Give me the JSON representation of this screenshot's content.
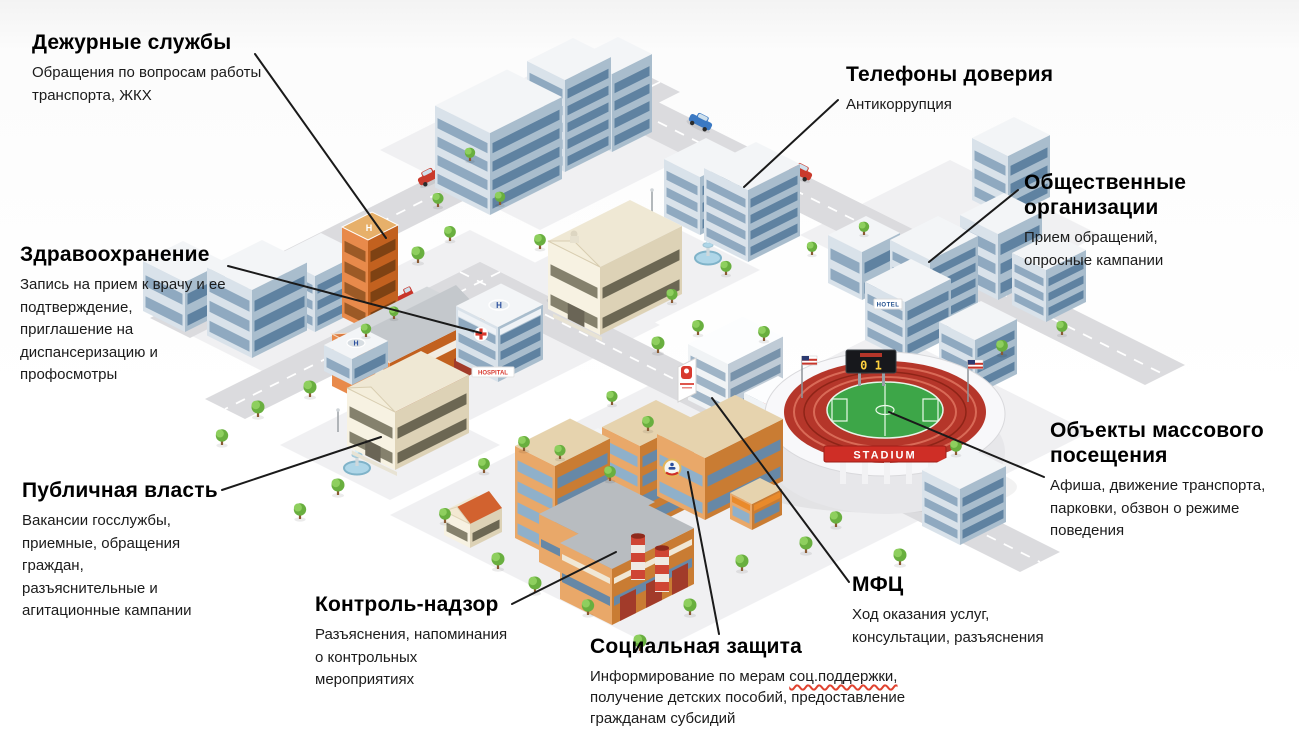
{
  "callouts": [
    {
      "id": "duty-services",
      "title": "Дежурные службы",
      "desc": "Обращения по вопросам работы\nтранспорта, ЖКХ"
    },
    {
      "id": "trust-phones",
      "title": "Телефоны доверия",
      "desc": "Антикоррупция"
    },
    {
      "id": "public-organizations",
      "title": "Общественные\nорганизации",
      "desc": "Прием обращений,\nопросные кампании"
    },
    {
      "id": "healthcare",
      "title": "Здравоохранение",
      "desc": "Запись на прием к врачу и ее\nподтверждение,\nприглашение на\nдиспансеризацию и\nпрофосмотры"
    },
    {
      "id": "public-authority",
      "title": "Публичная власть",
      "desc": "Вакансии госслужбы,\nприемные, обращения\nграждан,\nразъяснительные и\nагитационные кампании"
    },
    {
      "id": "control-supervision",
      "title": "Контроль-надзор",
      "desc": "Разъяснения, напоминания\nо контрольных\nмероприятиях"
    },
    {
      "id": "social-protection",
      "title": "Социальная защита",
      "desc_prefix": "Информирование по мерам ",
      "desc_marked": "соц.поддержки,",
      "desc_suffix": "\nполучение детских пособий, предоставление\nгражданам субсидий"
    },
    {
      "id": "mfc",
      "title": "МФЦ",
      "desc": "Ход оказания услуг,\nконсультации, разъяснения"
    },
    {
      "id": "mass-visit-objects",
      "title": "Объекты массового\nпосещения",
      "desc": "Афиша, движение транспорта,\nпарковки, обзвон о режиме\nповедения"
    }
  ],
  "city_texts": {
    "stadium_banner": "STADIUM",
    "scoreboard": "0 1",
    "hotel_sign": "HOTEL",
    "hospital_sign": "HOSPITAL",
    "helipad_letter": "H"
  },
  "colors": {
    "leader_line": "#1a1a1a",
    "title_text": "#000000",
    "body_text": "#1b1b1b",
    "spellcheck_underline": "#e0422f",
    "stadium_red": "#b5362a",
    "field_green": "#3da648",
    "brick_orange": "#c97c33",
    "glass_blue": "#a9bdcd"
  }
}
